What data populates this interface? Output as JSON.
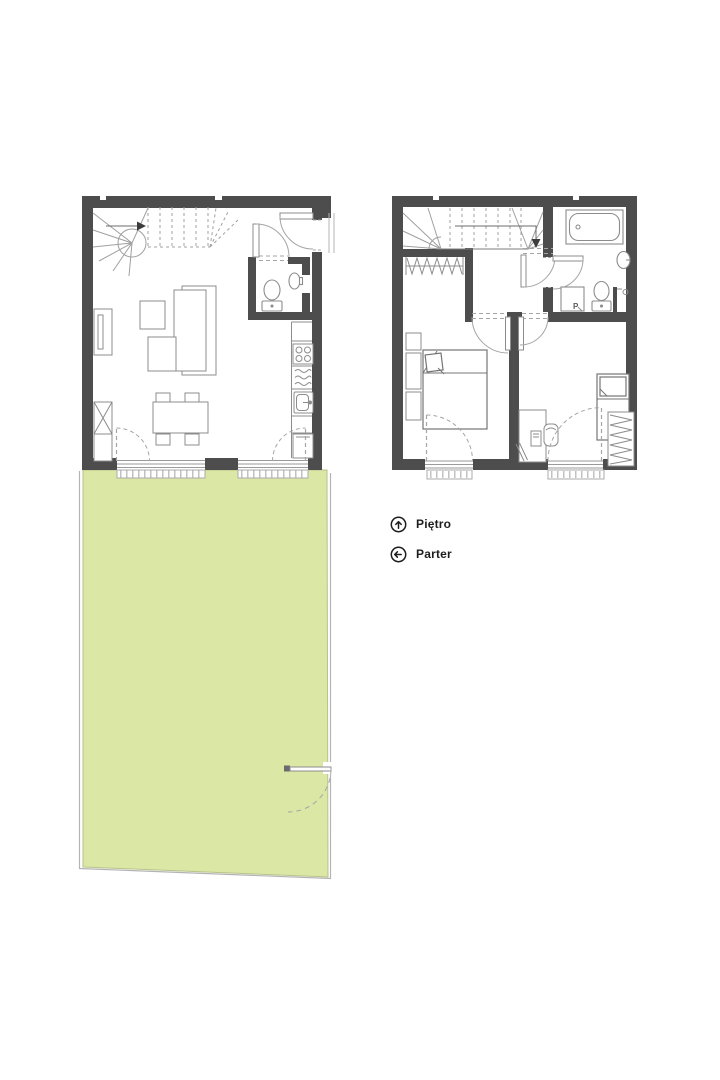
{
  "colors": {
    "background": "#ffffff",
    "wall": "#4d4d4d",
    "furniture_line": "#8c8c8c",
    "stair_line": "#a0a0a0",
    "garden_fill": "#dbe7a5",
    "garden_fence": "#b4b4b4",
    "text": "#1e1e1e"
  },
  "legend": {
    "items": [
      {
        "id": "pietro",
        "label": "Piętro",
        "icon": "arrow-up-circle-icon"
      },
      {
        "id": "parter",
        "label": "Parter",
        "icon": "arrow-left-circle-icon"
      }
    ]
  },
  "labels": {
    "washing_machine": "P"
  },
  "plans": {
    "parter": {
      "name": "Parter",
      "features": [
        "winder-staircase",
        "entrance-door",
        "wc-toilet",
        "wc-sink",
        "tv-cabinet",
        "armchair-table",
        "corner-sofa",
        "kitchen-cooktop",
        "kitchen-dishwasher",
        "kitchen-sink",
        "kitchen-fridge",
        "dining-table",
        "dining-chairs",
        "storage-cabinet",
        "garden-french-doors",
        "garden",
        "garden-gate"
      ]
    },
    "pietro": {
      "name": "Piętro",
      "features": [
        "winder-staircase",
        "wardrobe-niche",
        "hall",
        "bathroom-bathtub",
        "bathroom-sink",
        "bathroom-toilet",
        "washing-machine",
        "double-bed",
        "nightstands",
        "single-bed",
        "desk",
        "desk-chair",
        "wardrobe",
        "french-windows"
      ]
    }
  }
}
